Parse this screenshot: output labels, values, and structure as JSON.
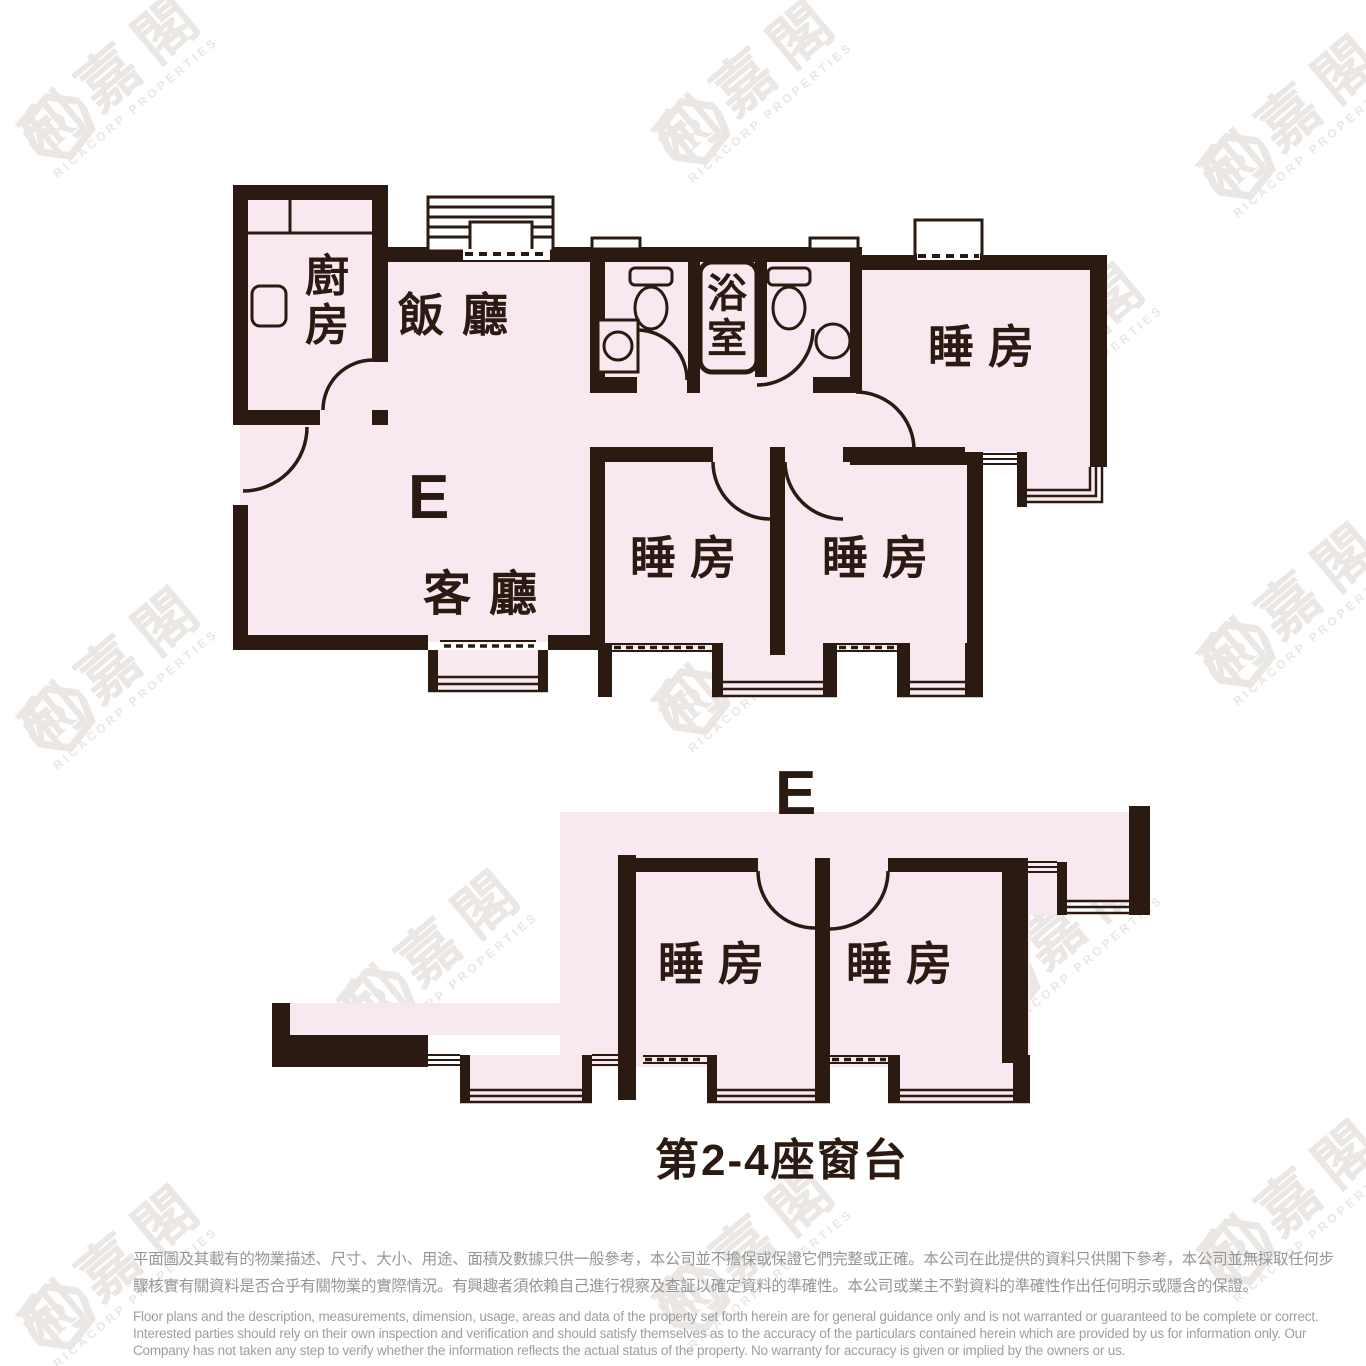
{
  "colors": {
    "wall": "#2a1a12",
    "room_fill": "#f8e8f0",
    "watermark": "#eae7e4",
    "disclaimer_text": "#969696",
    "label_text": "#2a1a12"
  },
  "upper_plan": {
    "unit_label": "E",
    "rooms": {
      "kitchen": {
        "label": "廚房"
      },
      "dining": {
        "label": "飯廳"
      },
      "bathroom": {
        "label": "浴室"
      },
      "bedroom_top_right": {
        "label": "睡房"
      },
      "living": {
        "label": "客廳"
      },
      "bedroom_mid_left": {
        "label": "睡房"
      },
      "bedroom_mid_right": {
        "label": "睡房"
      }
    }
  },
  "lower_plan": {
    "unit_label": "E",
    "rooms": {
      "bedroom_left": {
        "label": "睡房"
      },
      "bedroom_right": {
        "label": "睡房"
      }
    },
    "caption": "第2-4座窗台"
  },
  "watermark": {
    "logo_letter": "R",
    "chinese": "利嘉閣",
    "english": "RICACORP PROPERTIES",
    "positions": [
      {
        "x": 120,
        "y": 80
      },
      {
        "x": 755,
        "y": 85
      },
      {
        "x": 1300,
        "y": 120
      },
      {
        "x": 440,
        "y": 365
      },
      {
        "x": 1065,
        "y": 348
      },
      {
        "x": 120,
        "y": 672
      },
      {
        "x": 755,
        "y": 655
      },
      {
        "x": 1300,
        "y": 608
      },
      {
        "x": 440,
        "y": 955
      },
      {
        "x": 1065,
        "y": 938
      },
      {
        "x": 120,
        "y": 1270
      },
      {
        "x": 755,
        "y": 1252
      },
      {
        "x": 1300,
        "y": 1205
      }
    ]
  },
  "disclaimer": {
    "chinese_lines": [
      "平面圖及其載有的物業描述、尺寸、大小、用途、面積及數據只供一般參考，本公司並不擔保或保證它們完整或正確。本公司在此提供的資料只供閣下參考，本公司並無採取任何步",
      "驟核實有關資料是否合乎有關物業的實際情況。有興趣者須依賴自己進行視察及查証以確定資料的準確性。本公司或業主不對資料的準確性作出任何明示或隱含的保證。"
    ],
    "english_lines": [
      "Floor plans and the description, measurements, dimension, usage, areas and data of the property set forth herein are for general guidance only and is not warranted or guaranteed to be complete or correct.",
      "Interested parties should rely on their own inspection and verification and should satisfy themselves as to the accuracy of the particulars contained herein which are provided by us for information only.  Our",
      "Company has not taken any step to verify whether the information reflects the actual status of the property.  No warranty for accuracy is given or implied by the owners or us."
    ]
  }
}
